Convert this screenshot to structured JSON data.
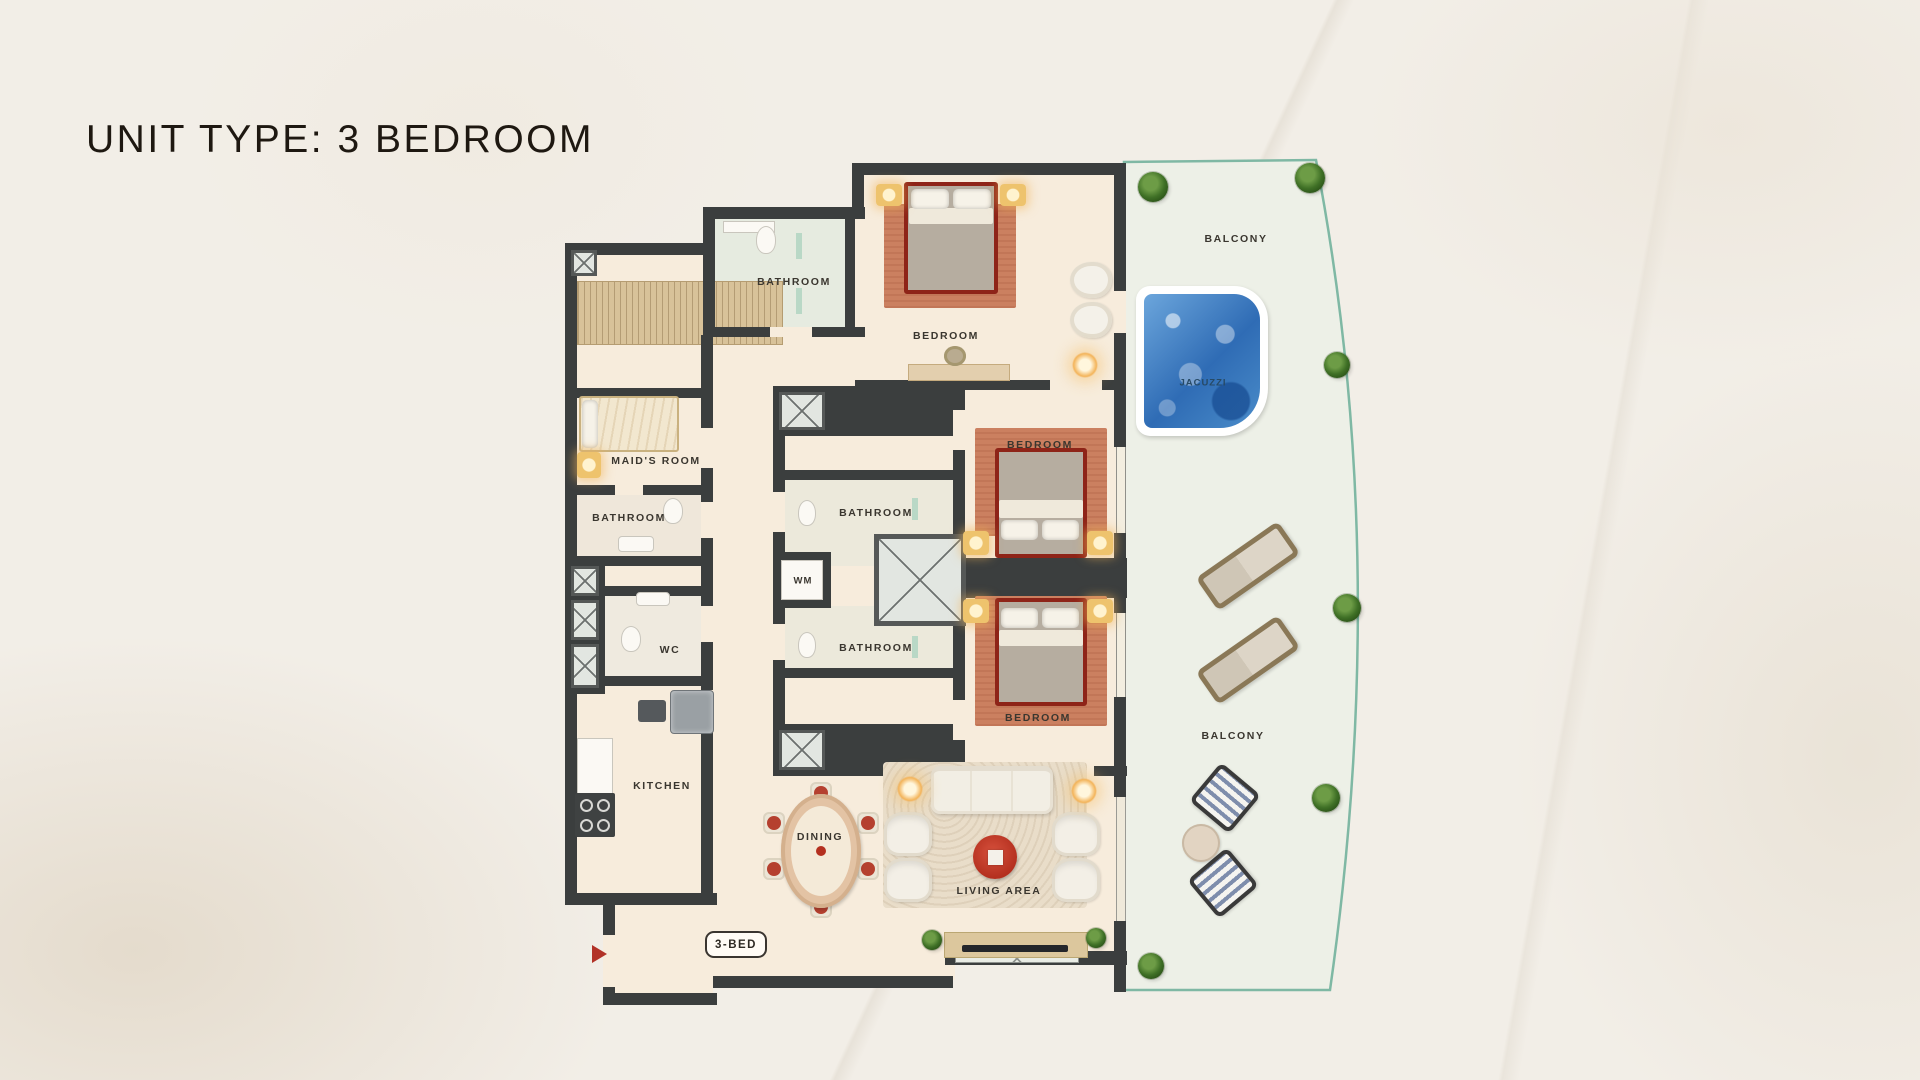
{
  "page": {
    "title": "UNIT TYPE: 3 BEDROOM",
    "unit_badge": "3-BED"
  },
  "floor_plan": {
    "labels": {
      "bathroom_top": "BATHROOM",
      "bedroom_top": "BEDROOM",
      "balcony_top": "BALCONY",
      "jacuzzi": "JACUZZI",
      "maids_room": "MAID'S ROOM",
      "bathroom_left": "BATHROOM",
      "bathroom_mid": "BATHROOM",
      "wm": "WM",
      "bathroom_low": "BATHROOM",
      "wc": "WC",
      "bedroom_mid": "BEDROOM",
      "bedroom_low": "BEDROOM",
      "kitchen": "KITCHEN",
      "dining": "DINING",
      "living_area": "LIVING AREA",
      "balcony_low": "BALCONY"
    },
    "colors": {
      "wall": "#3b3e3e",
      "floor": "#f7ecdc",
      "bath_floor": "#e9ece1",
      "wardrobe": "#d8c299",
      "balcony_floor": "#edf0e7",
      "balcony_edge": "#7fb8a4",
      "accent_red": "#b23227",
      "jacuzzi_blue": "#3f7fc4",
      "bed_frame_red": "#8e2418",
      "light_glow": "#f3b45a"
    }
  }
}
